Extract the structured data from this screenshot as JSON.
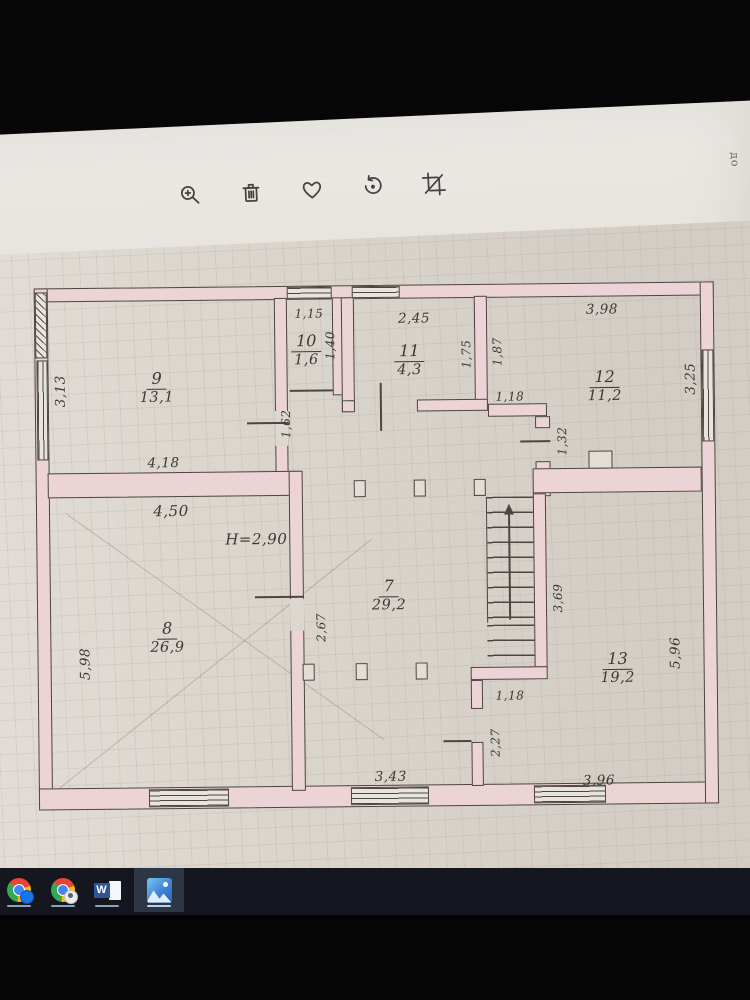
{
  "viewer": {
    "toolbar": {
      "icons": [
        {
          "name": "zoom-in"
        },
        {
          "name": "delete"
        },
        {
          "name": "favorite"
        },
        {
          "name": "rotate"
        },
        {
          "name": "crop"
        }
      ]
    }
  },
  "photo": {
    "corner_note": "до",
    "plan": {
      "height_note": "H=2,90",
      "rooms": [
        {
          "num": "9",
          "area": "13,1"
        },
        {
          "num": "10",
          "area": "1,6"
        },
        {
          "num": "11",
          "area": "4,3"
        },
        {
          "num": "12",
          "area": "11,2"
        },
        {
          "num": "7",
          "area": "29,2"
        },
        {
          "num": "8",
          "area": "26,9"
        },
        {
          "num": "13",
          "area": "19,2"
        }
      ],
      "dims": [
        "3,13",
        "4,18",
        "1,15",
        "1,40",
        "1,62",
        "2,45",
        "1,75",
        "3,98",
        "1,87",
        "1,18",
        "1,32",
        "3,25",
        "4,50",
        "2,67",
        "5,98",
        "3,69",
        "5,96",
        "1,18",
        "2,27",
        "3,43",
        "3,96"
      ]
    }
  },
  "taskbar": {
    "apps": [
      {
        "name": "chrome"
      },
      {
        "name": "chrome-profile"
      },
      {
        "name": "word"
      },
      {
        "name": "photos",
        "active": true
      }
    ]
  },
  "colors": {
    "wall_fill": "#ecd3d5",
    "ink": "#4c4543",
    "paper": "#dcd7cf",
    "taskbar": "#14171f",
    "word_blue": "#2b579a",
    "photos_blue": "#3f83d6"
  }
}
